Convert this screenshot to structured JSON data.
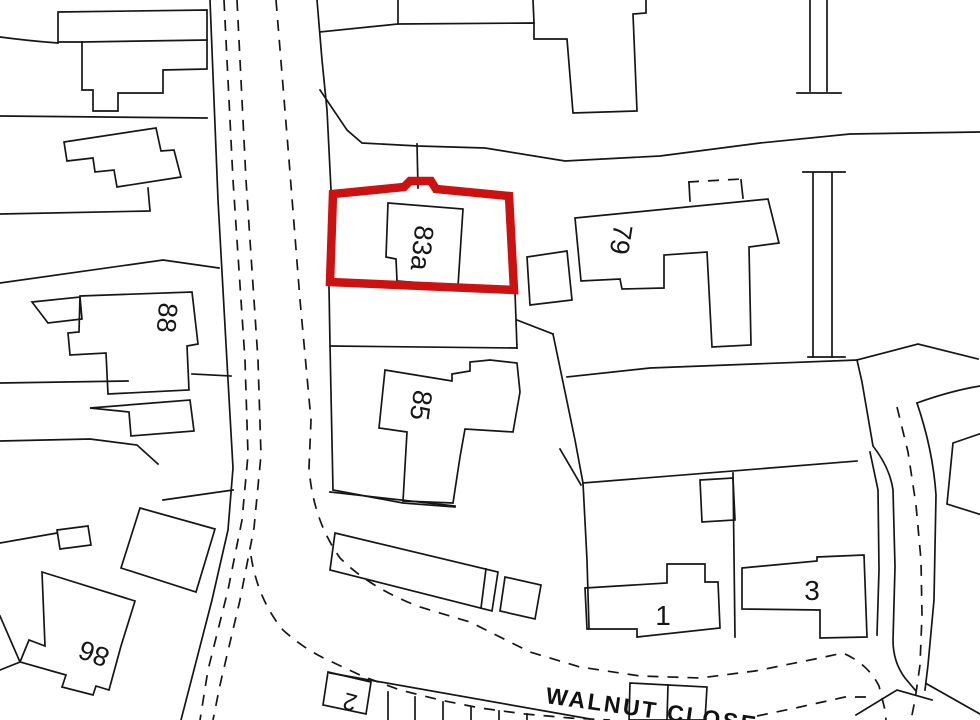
{
  "title": "Site location plan",
  "map": {
    "background": "#ffffff",
    "line_color": "#161616",
    "line_width": 1.7,
    "dash_pattern": "11,9",
    "boundary": {
      "name": "red-line site boundary around plot 83a",
      "color": "#cc1111",
      "width": 8.5,
      "path": "M333,194 L404,187 L410,181 L431,181 L436,189 L509,196 L514,290 L330,282 Z"
    },
    "street_label": {
      "text": "WALNUT CLOSE",
      "x": 545,
      "y": 703,
      "rotation": 8,
      "size": 23,
      "letter_spacing": 2.5
    },
    "labels": [
      {
        "text": "83a",
        "x": 413,
        "y": 247,
        "rotation": 96,
        "size": 27
      },
      {
        "text": "79",
        "x": 612,
        "y": 238,
        "rotation": 99,
        "size": 27
      },
      {
        "text": "88",
        "x": 158,
        "y": 317,
        "rotation": 95,
        "size": 27
      },
      {
        "text": "85",
        "x": 412,
        "y": 404,
        "rotation": 98,
        "size": 27
      },
      {
        "text": "86",
        "x": 97,
        "y": 645,
        "rotation": 200,
        "size": 27
      },
      {
        "text": "1",
        "x": 663,
        "y": 625,
        "rotation": 0,
        "size": 28
      },
      {
        "text": "3",
        "x": 812,
        "y": 600,
        "rotation": 0,
        "size": 28
      },
      {
        "text": "2",
        "x": 352,
        "y": 694,
        "rotation": 195,
        "size": 24
      }
    ],
    "solid_paths": [
      "M0,37 Q30,41 58,43",
      "M58,12 L207,10 L207,69 L163,70 L163,93 L118,93 L118,111 L93,111 L93,90 L82,90 L82,42 L58,42 Z",
      "M82,42 L207,40",
      "M0,116 L207,118",
      "M64,142 L156,128 L161,151 L174,150 L181,177 L117,187 L114,170 L95,172 L93,158 L67,161 Z",
      "M0,214 L150,211 L148,188",
      "M0,283 L163,260 L219,268",
      "M32,302 L80,297 L82,319 L48,323 Z",
      "M80,296 L192,292 L198,344 L187,346 L189,390 L108,394 L106,353 L70,355 L68,333 L79,332 Z",
      "M0,383 L128,381",
      "M192,374 L231,376",
      "M90,408 L190,400 L194,431 L131,436 L129,412 Z",
      "M0,441 L90,439 L137,445 L158,464",
      "M140,508 L215,529 L196,592 L121,568 Z",
      "M163,500 L233,490",
      "M57,530 L88,526 L91,545 L60,549 Z",
      "M0,543 L57,533",
      "M42,572 L135,601 L121,646 L109,690 L96,686 L93,695 L62,687 L66,675 L20,662 L29,640 L45,646 Z",
      "M0,616 L20,662 L0,670",
      "M210,0 L218,200 L228,380 L233,468 L228,530 L212,600 L196,662 L181,720",
      "M317,0 L322,60 L327,110 L331,190",
      "M329,287 L330,345 L333,490 L403,503 L455,507",
      "M320,90 L347,130 L362,143 L418,146 L485,148 L565,161 L660,156 L760,143 L850,134 L980,132",
      "M417,144 L418,188",
      "M320,32 L398,24 L398,0",
      "M398,24 L534,23 L534,39 L567,39 L573,113 L637,111 L633,14 L646,13 L646,0",
      "M533,0 L534,23",
      "M388,203 L463,209 L458,286 L397,281 L396,259 L386,257 Z",
      "M689,183 L690,201",
      "M741,180 L743,198",
      "M575,218 L768,199 L779,243 L749,247 L751,345 L712,347 L707,252 L664,255 L664,288 L622,289 L620,279 L581,281 Z",
      "M527,257 L567,251 L572,300 L530,305 Z",
      "M330,346 L517,348",
      "M515,292 L517,348",
      "M517,320 L553,334",
      "M553,334 L575,440 L583,483 L587,560 L589,628",
      "M567,377 L650,368 L857,360",
      "M583,483 L857,461",
      "M560,449 L581,485",
      "M385,370 L452,381 L452,374 L470,371 L470,362 L490,360 L517,363 L520,392 L513,432 L465,429 L460,457 L453,503 L403,501 L407,432 L379,428 Z",
      "M330,492 L455,506",
      "M335,533 L498,572 L492,611 L330,570 Z",
      "M486,569 L481,608",
      "M505,577 L541,585 L535,619 L500,611 Z",
      "M733,473 L735,637",
      "M700,480 L733,478 L735,520 L702,522 Z",
      "M585,588 L667,583 L667,564 L705,564 L705,582 L718,582 L720,628 L637,637 L637,629 L587,629 Z",
      "M742,568 L817,561 L817,557 L864,555 L867,637 L820,638 L820,610 L742,609 Z",
      "M857,360 L862,382 L873,446 Q890,468 893,490 L895,567 L893,640 Q893,662 905,678 L916,691",
      "M870,452 L878,490 L879,570 L877,635",
      "M917,403 Q933,450 936,495 L934,600 L928,665 L925,690",
      "M917,403 Q950,391 980,386",
      "M857,360 L918,344 L978,359",
      "M953,443 L985,432 L985,516 L947,504 Z",
      "M810,0 L810,91",
      "M827,0 L827,91",
      "M797,93 L841,93",
      "M803,172 L845,172",
      "M813,173 L813,357",
      "M832,173 L832,357",
      "M808,357 L845,357",
      "M330,673 L590,719",
      "M328,672 L371,682 L366,714 L323,705 Z",
      "M388,692 L388,720",
      "M415,697 L415,720",
      "M443,702 L443,720",
      "M471,707 L471,720",
      "M499,711 L499,720",
      "M527,714 L527,720",
      "M630,683 L707,687 L705,720 L629,720 Z",
      "M668,685 L667,720",
      "M856,715 L897,690 L932,700",
      "M927,684 L980,714"
    ],
    "dashed_paths": [
      "M224,0 L233,180 L245,360 L248,455 L242,520 L228,590 L208,670 L200,720",
      "M237,0 L246,180 L258,360 L261,455 L254,528 L240,600 L220,685 L213,720",
      "M276,0 L289,160 L300,300 L311,420 L309,468 Q313,520 340,558 Q370,588 420,607 L470,622 L530,652 L580,667 L640,676 L700,678 L755,671 L815,659 L843,653 Q868,664 879,686 L885,710 L886,720",
      "M897,407 L908,452 L916,505 L921,560 L922,615 L920,665 L915,700 L911,720",
      "M251,556 Q258,600 283,630 Q305,650 330,661 L362,676 L400,690 L440,700 L480,708 L525,714 L570,718 L610,720",
      "M757,716 L800,707 L845,697 L872,697",
      "M688,182 L742,179"
    ]
  }
}
